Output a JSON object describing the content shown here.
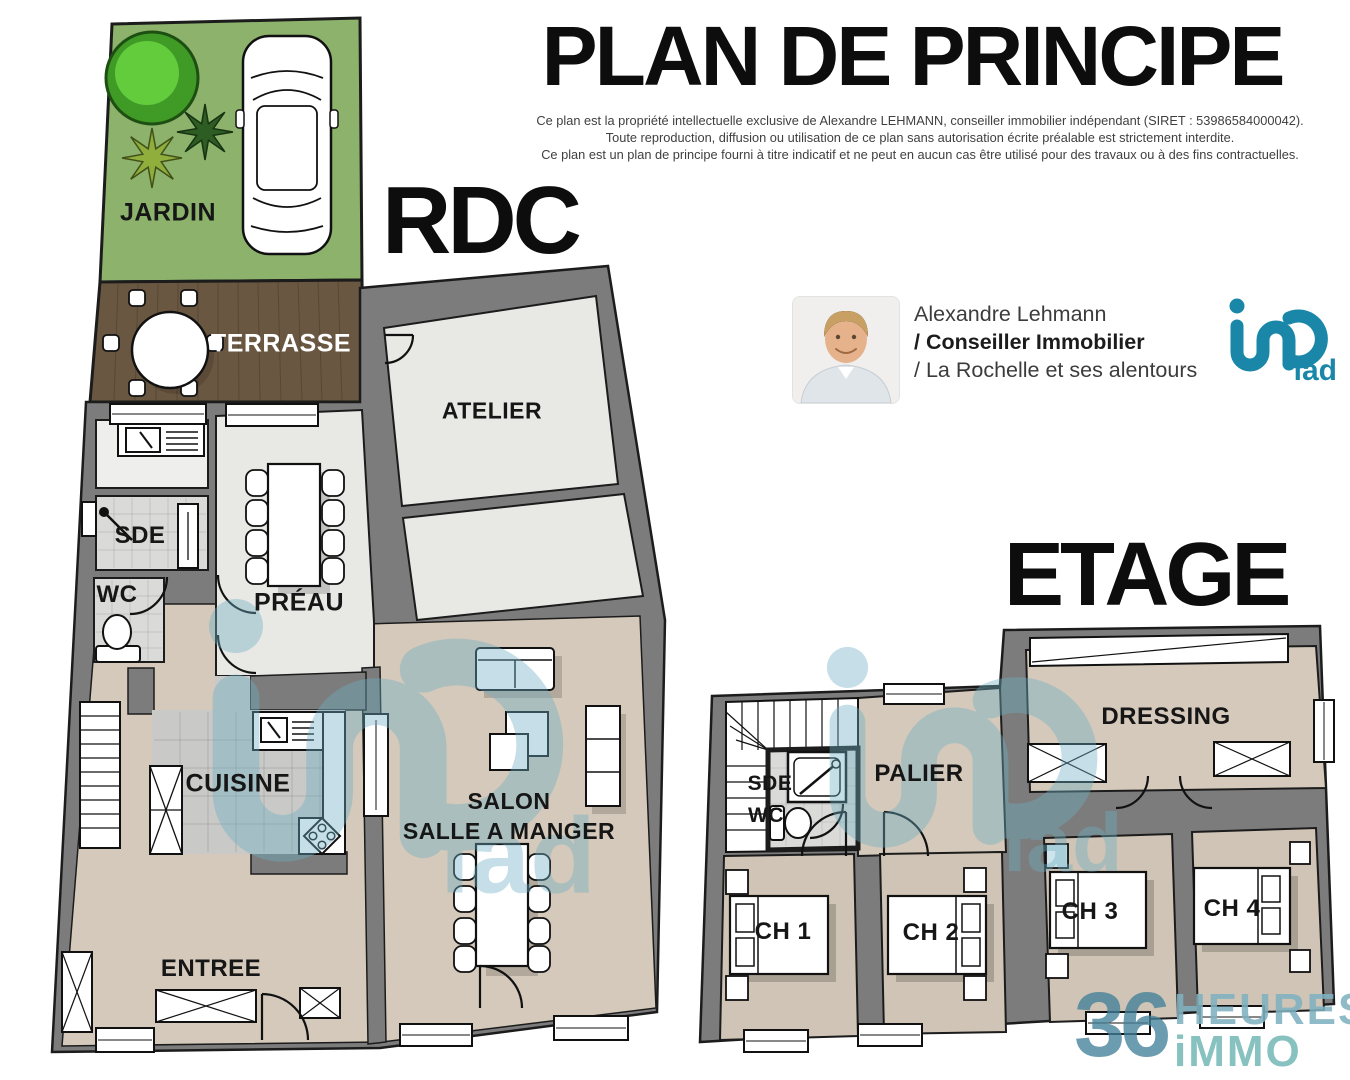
{
  "header": {
    "title": "PLAN DE PRINCIPE",
    "disclaimer": [
      "Ce plan est la propriété intellectuelle exclusive de Alexandre LEHMANN, conseiller immobilier indépendant (SIRET : 53986584000042).",
      "Toute reproduction, diffusion ou utilisation de ce plan sans autorisation écrite préalable est strictement interdite.",
      "Ce plan est un plan de principe fourni à titre indicatif et ne peut en aucun cas être utilisé pour des travaux ou à des fins contractuelles."
    ]
  },
  "agent": {
    "name": "Alexandre Lehmann",
    "role": "/ Conseiller Immobilier",
    "territory": "/ La Rochelle et ses alentours"
  },
  "brands": {
    "iad": "iad",
    "hours36_number": "36",
    "hours36_word1": "HEURES",
    "hours36_word2": "iMMO"
  },
  "floors": {
    "rdc": {
      "label": "RDC",
      "rooms": {
        "jardin": "JARDIN",
        "terrasse": "TERRASSE",
        "atelier": "ATELIER",
        "sde": "SDE",
        "wc": "WC",
        "preau": "PRÉAU",
        "cuisine": "CUISINE",
        "salon1": "SALON",
        "salon2": "SALLE A MANGER",
        "entree": "ENTREE"
      }
    },
    "etage": {
      "label": "ETAGE",
      "rooms": {
        "sde": "SDE",
        "wc": "WC",
        "palier": "PALIER",
        "dressing": "DRESSING",
        "ch1": "CH 1",
        "ch2": "CH 2",
        "ch3": "CH 3",
        "ch4": "CH 4"
      }
    }
  },
  "colors": {
    "accent": "#1a87a8",
    "watermark": "#6fafc4",
    "wall": "#7c7c7c",
    "floor_beige": "#d4c9ba",
    "concrete": "#e8e8e5",
    "grass": "#8cb26c",
    "terrace": "#6a5741"
  }
}
